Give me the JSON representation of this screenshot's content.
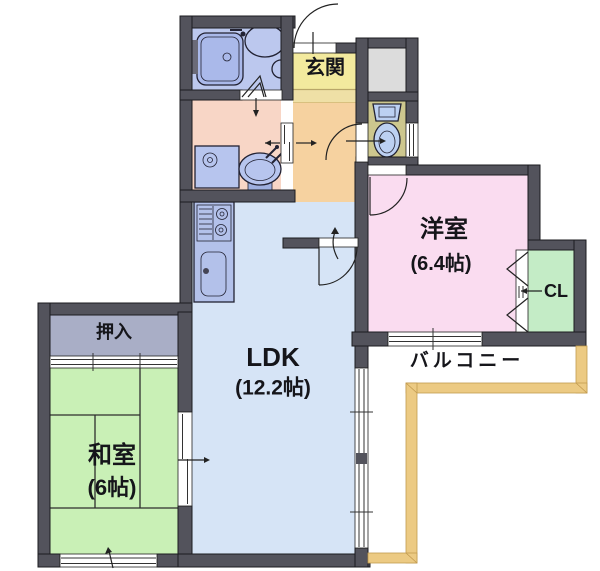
{
  "floorplan": {
    "rooms": {
      "genkan": {
        "label": "玄関"
      },
      "western_room": {
        "label": "洋室",
        "size": "(6.4帖)"
      },
      "closet_cl": {
        "label": "CL"
      },
      "ldk": {
        "label": "LDK",
        "size": "(12.2帖)"
      },
      "japanese_room": {
        "label": "和室",
        "size": "(6帖)"
      },
      "oshiire": {
        "label": "押入"
      },
      "balcony": {
        "label": "バルコニー"
      }
    },
    "colors": {
      "wall": "#53535c",
      "ldk_floor": "#d6e4f6",
      "japanese_room_floor": "#c9f0b6",
      "western_room_floor": "#fadcf0",
      "closet_floor": "#c4ecc6",
      "genkan_floor": "#f3ea9e",
      "genkan_step": "#efe0a6",
      "hall_floor": "#f6d2a0",
      "washroom_floor": "#f8d6c6",
      "bathroom_floor": "#bcc8ee",
      "toilet_floor": "#cdc78e",
      "oshiire_floor": "#a9aec6",
      "gray_box": "#dcdcdc",
      "kitchen_counter": "#b3c1ea",
      "fixture": "#b7c5ee",
      "balcony_rail": "#ecca83"
    },
    "icons": [
      "bathtub-icon",
      "washbasin-icon",
      "washing-machine-icon",
      "toilet-icon",
      "stove-icon",
      "kitchen-sink-icon"
    ]
  }
}
